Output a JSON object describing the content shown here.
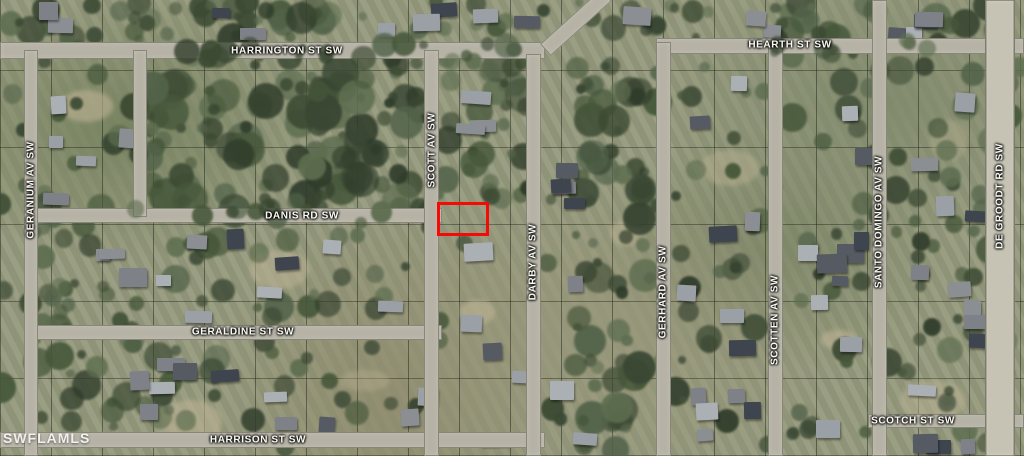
{
  "map": {
    "watermark": "SWFLAMLS",
    "colors": {
      "parcel_highlight": "#f40b05"
    },
    "streets": {
      "harrington": "HARRINGTON ST SW",
      "hearth": "HEARTH ST SW",
      "danis": "DANIS RD SW",
      "geraldine": "GERALDINE ST SW",
      "harrison": "HARRISON ST SW",
      "scotch": "SCOTCH ST SW",
      "geranium": "GERANIUM AV SW",
      "scott": "SCOTT AV SW",
      "darby": "DARBY AV SW",
      "gerhard": "GERHARD AV SW",
      "scotten": "SCOTTEN AV SW",
      "santo_domingo": "SANTO DOMINGO AV SW",
      "de_groodt": "DE GROODT RD SW"
    }
  }
}
